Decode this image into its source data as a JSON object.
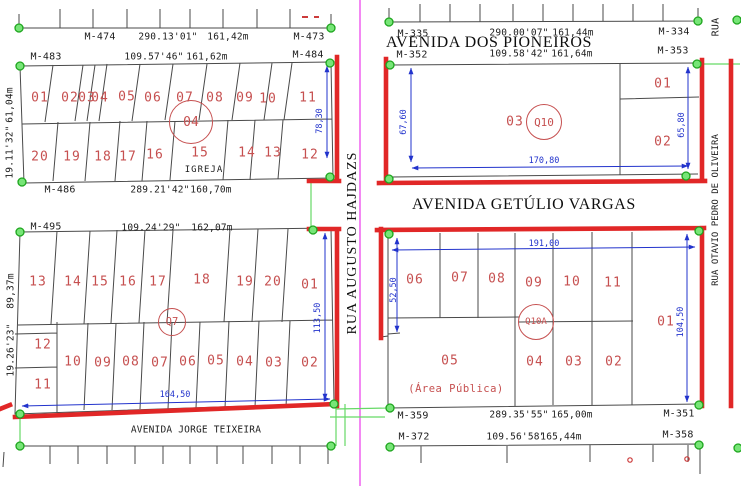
{
  "colors": {
    "boundary_red": "#e12727",
    "lot_red": "#c65050",
    "dim_blue": "#2233cc",
    "centerline_magenta": "#ee55ee",
    "marker_green": "#33cc33",
    "line_black": "#4a4a4a",
    "background": "#ffffff"
  },
  "strips": {
    "tl_road": {
      "m_left": "M-474",
      "bearing": "290.13'01\"",
      "length": "161,42m",
      "m_right": "M-473"
    },
    "q4_top": {
      "m_left": "M-483",
      "bearing": "109.57'46\"",
      "length": "161,62m",
      "m_right": "M-484"
    },
    "q4_bottom": {
      "m_left": "M-486",
      "bearing": "289.21'42\"",
      "length": "160,70m"
    },
    "q7_top": {
      "m_left": "M-495",
      "bearing": "109.24'29\"",
      "length": "162,07m"
    },
    "tr_road": {
      "m_left": "M-335",
      "bearing": "290.00'07\"",
      "length": "161,44m",
      "m_right": "M-334"
    },
    "q10_top": {
      "m_left": "M-352",
      "bearing": "109.58'42\"",
      "length": "161,64m",
      "m_right": "M-353"
    },
    "q10a_bottom": {
      "m_left": "M-359",
      "bearing": "289.35'55\"",
      "length": "165,00m",
      "m_right": "M-351"
    },
    "br_road": {
      "m_left": "M-372",
      "bearing": "109.56'58\"",
      "length": "165,44m",
      "m_right": "M-358"
    }
  },
  "streets": {
    "pioneiros": "AVENIDA DOS PIONEIROS",
    "getulio": "AVENIDA GETÚLIO VARGAS",
    "jorge": "AVENIDA JORGE TEIXEIRA",
    "hajdazs": "RUA AUGUSTO HAJDAZS",
    "otavio": "RUA OTAVIO PEDRO DE OLIVEIRA",
    "rua_corner": "RUA"
  },
  "blocks": {
    "q4": {
      "circle": "04",
      "row1": [
        "01",
        "02",
        "03",
        "04",
        "05",
        "06",
        "07",
        "08",
        "09",
        "10",
        "11"
      ],
      "row2": [
        "20",
        "19",
        "18",
        "17",
        "16",
        "15",
        "14",
        "13",
        "12"
      ],
      "church": "IGREJA",
      "side_left": [
        "61,04m",
        "19.11'32\""
      ],
      "side_right": "78,30"
    },
    "q7": {
      "circle": "Q7",
      "row1": [
        "13",
        "14",
        "15",
        "16",
        "17",
        "18",
        "19",
        "20",
        "01"
      ],
      "row2": [
        "12",
        "11",
        "10",
        "09",
        "08",
        "07",
        "06",
        "05",
        "04",
        "03",
        "02"
      ],
      "side_left": [
        "89,37m",
        "19.26'23\""
      ],
      "side_right": "113,50",
      "bottom": "164,50"
    },
    "q10": {
      "circle": "Q10",
      "lot_main": "03",
      "lot_tr": "01",
      "lot_br": "02",
      "dim_left": "67,60",
      "dim_right": "65,80",
      "dim_bottom": "170,80"
    },
    "q10a": {
      "circle": "Q10A",
      "row_top": [
        "06",
        "07",
        "08",
        "09",
        "10",
        "11"
      ],
      "row_bottom": [
        "05",
        "04",
        "03",
        "02"
      ],
      "lot_right": "01",
      "area": "(Área Pública)",
      "dim_top": "191,00",
      "dim_left": "52,50",
      "dim_right": "104,50"
    }
  }
}
